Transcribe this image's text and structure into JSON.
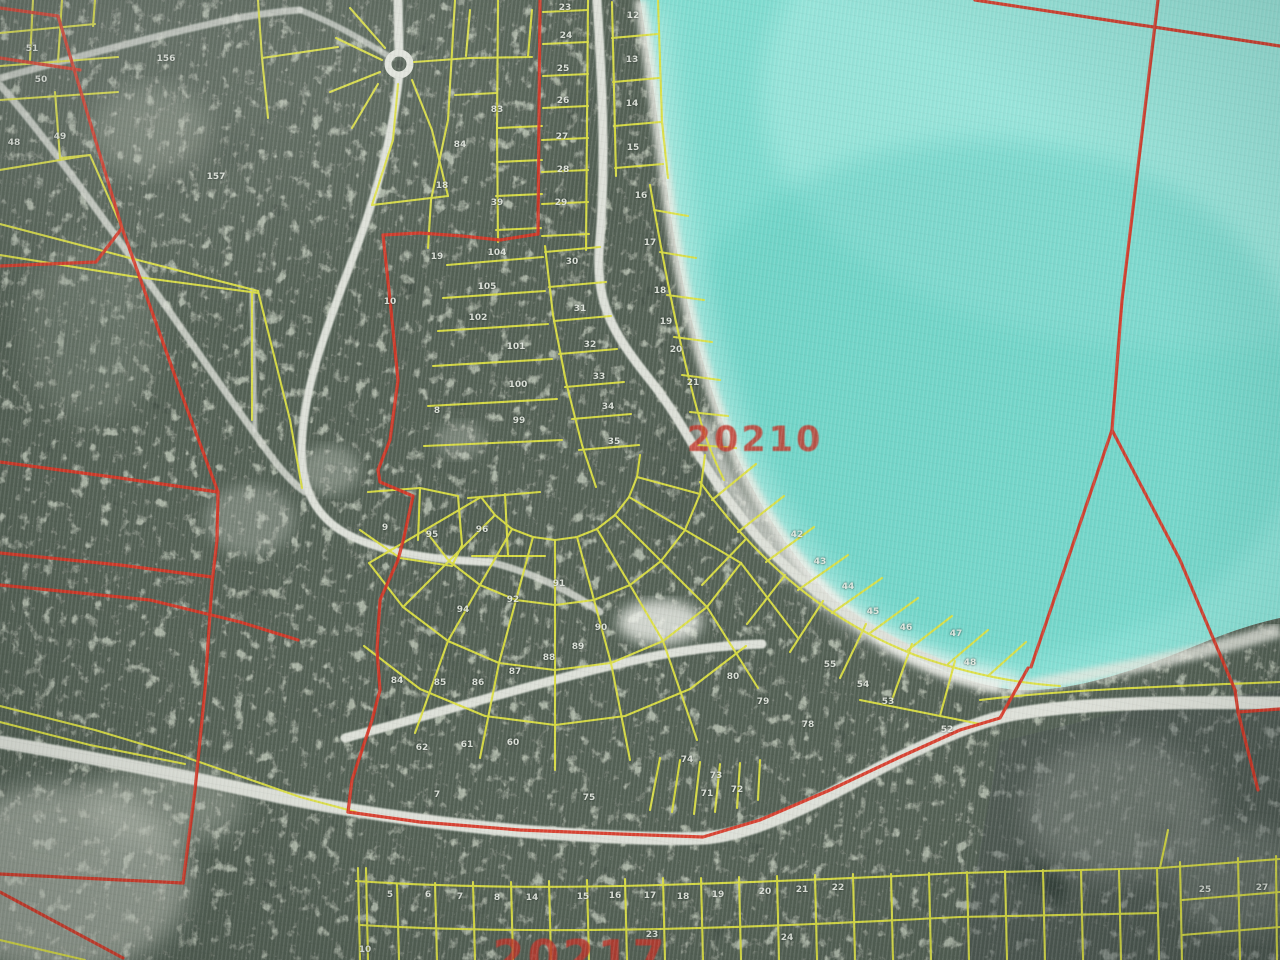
{
  "map": {
    "description": "aerial parcel map photo",
    "colors": {
      "water": "#74d9cb",
      "water_deep": "#5fcfc2",
      "water_light": "#a8ece2",
      "shallow": "#baf0e6",
      "land": "#414d45",
      "land_patch": "#96a091",
      "land_speckle": "#b6bfae",
      "sand": "#e9ebe3",
      "road": "#dde0d8",
      "parcel_line": "#dde13a",
      "boundary_line": "#dd3322",
      "region_label_red": "#c4372b",
      "number_white": "#e6eae2"
    },
    "region_labels": [
      {
        "text": "20210",
        "x": 755,
        "y": 440,
        "size": 35
      },
      {
        "text": "20217",
        "x": 580,
        "y": 957,
        "size": 46
      }
    ],
    "parcel_numbers": [
      {
        "t": "51",
        "x": 32,
        "y": 49
      },
      {
        "t": "50",
        "x": 41,
        "y": 80
      },
      {
        "t": "49",
        "x": 60,
        "y": 137
      },
      {
        "t": "48",
        "x": 14,
        "y": 143
      },
      {
        "t": "156",
        "x": 166,
        "y": 59
      },
      {
        "t": "157",
        "x": 216,
        "y": 177
      },
      {
        "t": "10",
        "x": 390,
        "y": 302
      },
      {
        "t": "8",
        "x": 437,
        "y": 411
      },
      {
        "t": "9",
        "x": 385,
        "y": 528
      },
      {
        "t": "104",
        "x": 497,
        "y": 253
      },
      {
        "t": "105",
        "x": 487,
        "y": 287
      },
      {
        "t": "102",
        "x": 478,
        "y": 318
      },
      {
        "t": "101",
        "x": 516,
        "y": 347
      },
      {
        "t": "100",
        "x": 518,
        "y": 385
      },
      {
        "t": "99",
        "x": 519,
        "y": 421
      },
      {
        "t": "95",
        "x": 432,
        "y": 535
      },
      {
        "t": "96",
        "x": 482,
        "y": 530
      },
      {
        "t": "94",
        "x": 463,
        "y": 610
      },
      {
        "t": "84",
        "x": 460,
        "y": 145
      },
      {
        "t": "83",
        "x": 497,
        "y": 110
      },
      {
        "t": "18",
        "x": 442,
        "y": 186
      },
      {
        "t": "39",
        "x": 497,
        "y": 203
      },
      {
        "t": "19",
        "x": 437,
        "y": 257
      },
      {
        "t": "23",
        "x": 565,
        "y": 8
      },
      {
        "t": "24",
        "x": 566,
        "y": 36
      },
      {
        "t": "25",
        "x": 563,
        "y": 69
      },
      {
        "t": "26",
        "x": 563,
        "y": 101
      },
      {
        "t": "27",
        "x": 562,
        "y": 137
      },
      {
        "t": "28",
        "x": 563,
        "y": 170
      },
      {
        "t": "29",
        "x": 561,
        "y": 203
      },
      {
        "t": "12",
        "x": 633,
        "y": 16
      },
      {
        "t": "13",
        "x": 632,
        "y": 60
      },
      {
        "t": "14",
        "x": 632,
        "y": 104
      },
      {
        "t": "15",
        "x": 633,
        "y": 148
      },
      {
        "t": "16",
        "x": 641,
        "y": 196
      },
      {
        "t": "17",
        "x": 650,
        "y": 243
      },
      {
        "t": "18",
        "x": 660,
        "y": 291
      },
      {
        "t": "19",
        "x": 666,
        "y": 322
      },
      {
        "t": "20",
        "x": 676,
        "y": 350
      },
      {
        "t": "21",
        "x": 693,
        "y": 383
      },
      {
        "t": "30",
        "x": 572,
        "y": 262
      },
      {
        "t": "31",
        "x": 580,
        "y": 309
      },
      {
        "t": "32",
        "x": 590,
        "y": 345
      },
      {
        "t": "33",
        "x": 599,
        "y": 377
      },
      {
        "t": "34",
        "x": 608,
        "y": 407
      },
      {
        "t": "35",
        "x": 614,
        "y": 442
      },
      {
        "t": "42",
        "x": 797,
        "y": 535
      },
      {
        "t": "43",
        "x": 820,
        "y": 562
      },
      {
        "t": "44",
        "x": 848,
        "y": 587
      },
      {
        "t": "45",
        "x": 873,
        "y": 612
      },
      {
        "t": "46",
        "x": 906,
        "y": 628
      },
      {
        "t": "47",
        "x": 956,
        "y": 634
      },
      {
        "t": "48",
        "x": 970,
        "y": 663
      },
      {
        "t": "52",
        "x": 947,
        "y": 730
      },
      {
        "t": "53",
        "x": 888,
        "y": 702
      },
      {
        "t": "54",
        "x": 863,
        "y": 685
      },
      {
        "t": "55",
        "x": 830,
        "y": 665
      },
      {
        "t": "91",
        "x": 559,
        "y": 584
      },
      {
        "t": "92",
        "x": 513,
        "y": 600
      },
      {
        "t": "90",
        "x": 601,
        "y": 628
      },
      {
        "t": "89",
        "x": 578,
        "y": 647
      },
      {
        "t": "88",
        "x": 549,
        "y": 658
      },
      {
        "t": "87",
        "x": 515,
        "y": 672
      },
      {
        "t": "86",
        "x": 478,
        "y": 683
      },
      {
        "t": "85",
        "x": 440,
        "y": 683
      },
      {
        "t": "84",
        "x": 397,
        "y": 681
      },
      {
        "t": "80",
        "x": 733,
        "y": 677
      },
      {
        "t": "79",
        "x": 763,
        "y": 702
      },
      {
        "t": "78",
        "x": 808,
        "y": 725
      },
      {
        "t": "60",
        "x": 513,
        "y": 743
      },
      {
        "t": "61",
        "x": 467,
        "y": 745
      },
      {
        "t": "62",
        "x": 422,
        "y": 748
      },
      {
        "t": "74",
        "x": 687,
        "y": 760
      },
      {
        "t": "75",
        "x": 589,
        "y": 798
      },
      {
        "t": "73",
        "x": 716,
        "y": 776
      },
      {
        "t": "72",
        "x": 737,
        "y": 790
      },
      {
        "t": "71",
        "x": 707,
        "y": 794
      },
      {
        "t": "7",
        "x": 437,
        "y": 795
      },
      {
        "t": "5",
        "x": 390,
        "y": 895
      },
      {
        "t": "6",
        "x": 428,
        "y": 895
      },
      {
        "t": "7",
        "x": 460,
        "y": 897
      },
      {
        "t": "8",
        "x": 497,
        "y": 898
      },
      {
        "t": "14",
        "x": 532,
        "y": 898
      },
      {
        "t": "15",
        "x": 583,
        "y": 897
      },
      {
        "t": "16",
        "x": 615,
        "y": 896
      },
      {
        "t": "17",
        "x": 650,
        "y": 896
      },
      {
        "t": "18",
        "x": 683,
        "y": 897
      },
      {
        "t": "19",
        "x": 718,
        "y": 895
      },
      {
        "t": "20",
        "x": 765,
        "y": 892
      },
      {
        "t": "21",
        "x": 802,
        "y": 890
      },
      {
        "t": "22",
        "x": 838,
        "y": 888
      },
      {
        "t": "23",
        "x": 652,
        "y": 935
      },
      {
        "t": "24",
        "x": 787,
        "y": 938
      },
      {
        "t": "10",
        "x": 365,
        "y": 950
      },
      {
        "t": "25",
        "x": 1205,
        "y": 890
      },
      {
        "t": "27",
        "x": 1262,
        "y": 888
      }
    ]
  }
}
